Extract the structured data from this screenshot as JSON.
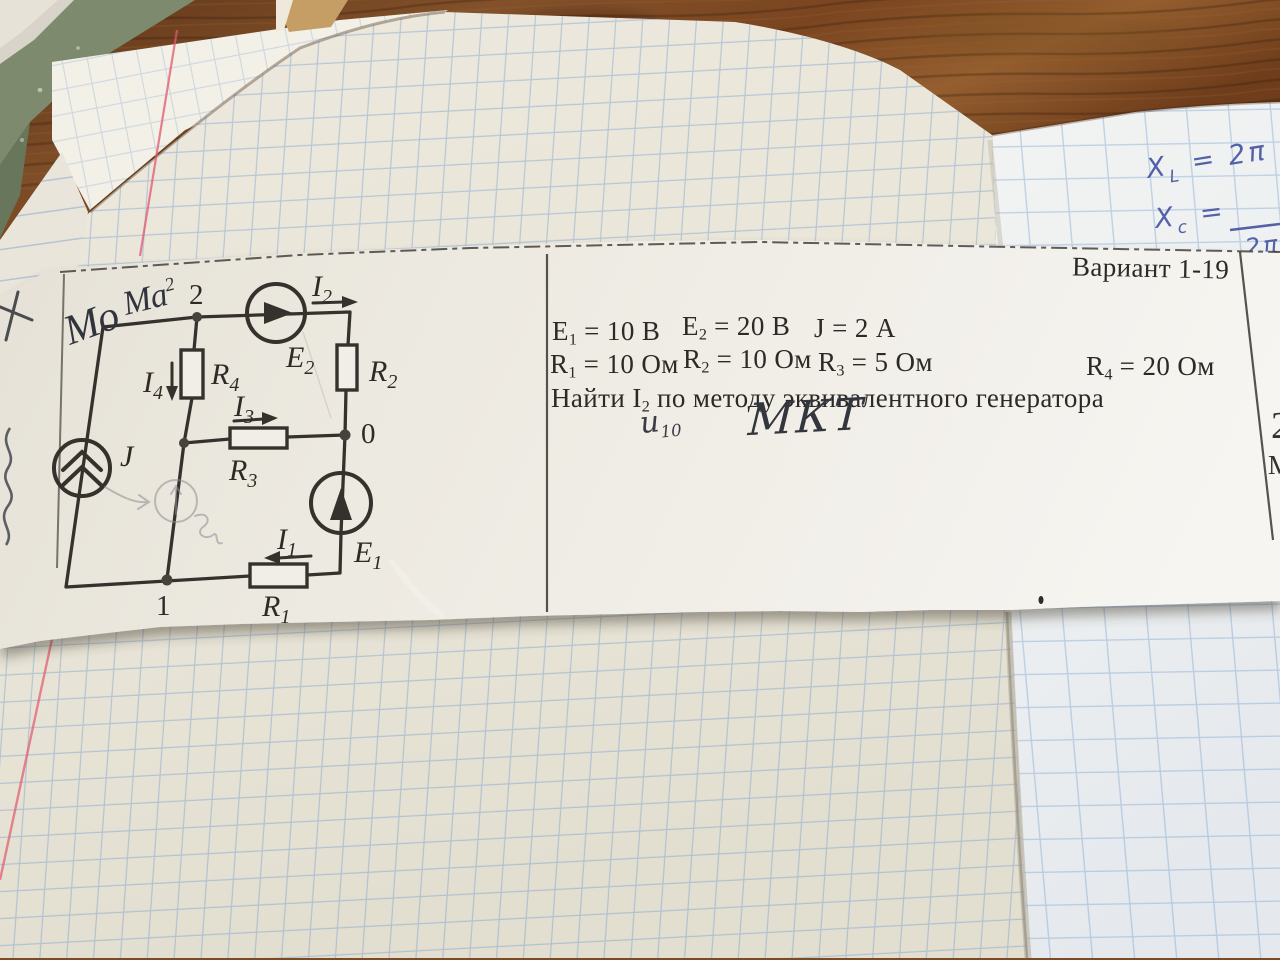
{
  "scene": {
    "desk": {
      "material": "wood-table",
      "wood_color": "#7c4a24"
    },
    "notebook": {
      "paper": "squared-grid",
      "pen_color": "#5361a8",
      "handwriting": {
        "xl": {
          "base": "X",
          "sub": "L",
          "rest": " = 2π"
        },
        "xc": {
          "base": "X",
          "sub": "c",
          "rest": " ="
        },
        "xc_denominator": "2π"
      }
    },
    "strip": {
      "variant_label": "Вариант 1-19",
      "given_row1": [
        {
          "base": "E",
          "sub": "1",
          "rest": " = 10 В"
        },
        {
          "base": "E",
          "sub": "2",
          "rest": " = 20 В"
        },
        {
          "base": "J",
          "sub": "",
          "rest": " = 2 А"
        }
      ],
      "given_row2": [
        {
          "base": "R",
          "sub": "1",
          "rest": " = 10 Ом"
        },
        {
          "base": "R",
          "sub": "2",
          "rest": " = 10 Ом"
        },
        {
          "base": "R",
          "sub": "3",
          "rest": " = 5 Ом"
        },
        {
          "base": "R",
          "sub": "4",
          "rest": " = 20 Ом"
        }
      ],
      "task": {
        "base": "Найти I",
        "sub": "2",
        "rest": " по методу эквивалентного генератора"
      },
      "handwritten_note_u": {
        "base": "u",
        "sub": "10"
      },
      "handwritten_note_method": "МКТ",
      "corner_scribble_1": "Мо",
      "corner_scribble_2": {
        "base": "Ма",
        "sup": "2"
      },
      "edge_fragment_top": "2",
      "edge_fragment_bottom": "М",
      "circuit": {
        "node_labels": {
          "n2": "2",
          "n0": "0",
          "n1": "1"
        },
        "source_labels": {
          "J": "J",
          "E1": {
            "base": "E",
            "sub": "1"
          },
          "E2": {
            "base": "E",
            "sub": "2"
          }
        },
        "resistor_labels": {
          "R1": {
            "base": "R",
            "sub": "1"
          },
          "R2": {
            "base": "R",
            "sub": "2"
          },
          "R3": {
            "base": "R",
            "sub": "3"
          },
          "R4": {
            "base": "R",
            "sub": "4"
          }
        },
        "current_labels": {
          "I1": {
            "base": "I",
            "sub": "1"
          },
          "I2": {
            "base": "I",
            "sub": "2"
          },
          "I3": {
            "base": "I",
            "sub": "3"
          },
          "I4": {
            "base": "I",
            "sub": "4"
          }
        }
      }
    }
  }
}
